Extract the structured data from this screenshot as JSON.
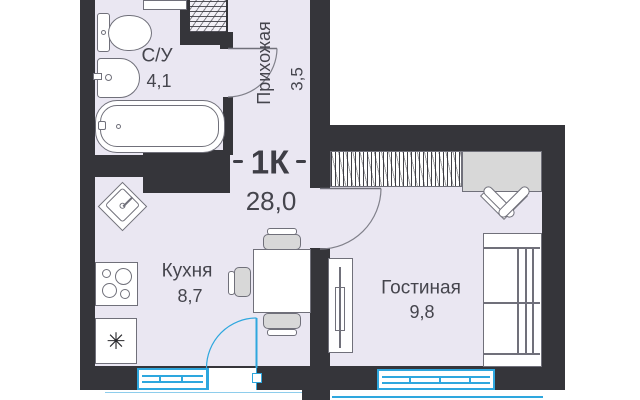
{
  "plan": {
    "title": {
      "type_label": "1К",
      "total_area": "28,0"
    },
    "rooms": [
      {
        "id": "bathroom",
        "name": "С/У",
        "area": "4,1"
      },
      {
        "id": "hallway",
        "name": "Прихожая",
        "area": "3,5"
      },
      {
        "id": "kitchen",
        "name": "Кухня",
        "area": "8,7"
      },
      {
        "id": "living",
        "name": "Гостиная",
        "area": "9,8"
      }
    ],
    "icons": {
      "fridge_glyph": "✳"
    },
    "colors": {
      "wall": "#35353a",
      "floor": "#eae7f2",
      "window_blue": "#2ea7de",
      "furniture_gray": "#d8d8d8",
      "text": "#45454d"
    }
  }
}
